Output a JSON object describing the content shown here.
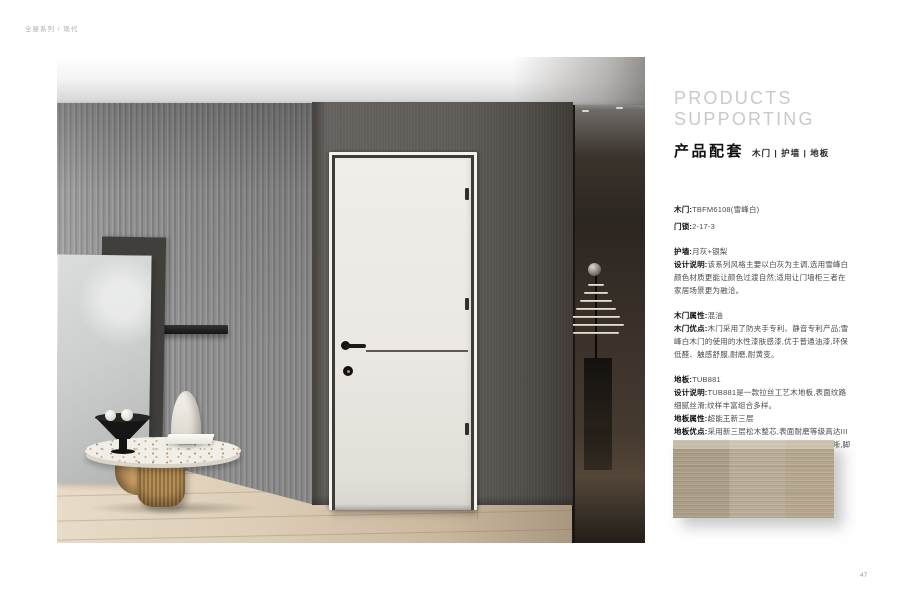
{
  "header": {
    "breadcrumb": "全屋系列 / 现代"
  },
  "panel": {
    "heading_line1": "PRODUCTS",
    "heading_line2": "SUPPORTING",
    "title": "产品配套",
    "subtitle": "木门 | 护墙 | 地板",
    "sections": [
      {
        "items": [
          {
            "label": "木门:",
            "text": "TBFM6108(雪峰白)"
          },
          {
            "label": "门锁:",
            "text": "2-17-3"
          }
        ]
      },
      {
        "items": [
          {
            "label": "护墙:",
            "text": "月灰+银梨"
          },
          {
            "label": "设计说明:",
            "text": "该系列风格主要以白灰为主调,选用雪峰白颜色材质更能让颜色过渡自然;适用让门墙柜三者在家居场景更为融洽。"
          }
        ]
      },
      {
        "items": [
          {
            "label": "木门属性:",
            "text": "混油"
          },
          {
            "label": "木门优点:",
            "text": "木门采用了防夹手专利、静音专利产品;雪峰白木门的使用的水性漆肤感漆,优于普通油漆,环保低醛、触感舒服,耐磨,耐黄变。"
          }
        ]
      },
      {
        "items": [
          {
            "label": "地板:",
            "text": "TUB881"
          },
          {
            "label": "设计说明:",
            "text": "TUB881是一款拉丝工艺木地板,表面纹路细腻丝滑;纹样丰富组合多样。"
          },
          {
            "label": "地板属性:",
            "text": "超能王新三层"
          },
          {
            "label": "地板优点:",
            "text": "采用新三层松木整芯,表面耐磨等级高达III级;并且引入最新除醛抗菌技术,拉丝工艺木纹清晰,脚感舒适。"
          }
        ]
      }
    ],
    "colors": {
      "heading_gray": "#c9c9c9",
      "title_black": "#111111",
      "body_text": "#4a4a4a",
      "swatch_wood": "#b4a58e",
      "accent_wall": "#5e5a55",
      "slat_wall": "#8f8f8f",
      "door_white": "#efede9",
      "floor_wood": "#d8c9b2"
    }
  },
  "footer": {
    "page_number": "47"
  }
}
